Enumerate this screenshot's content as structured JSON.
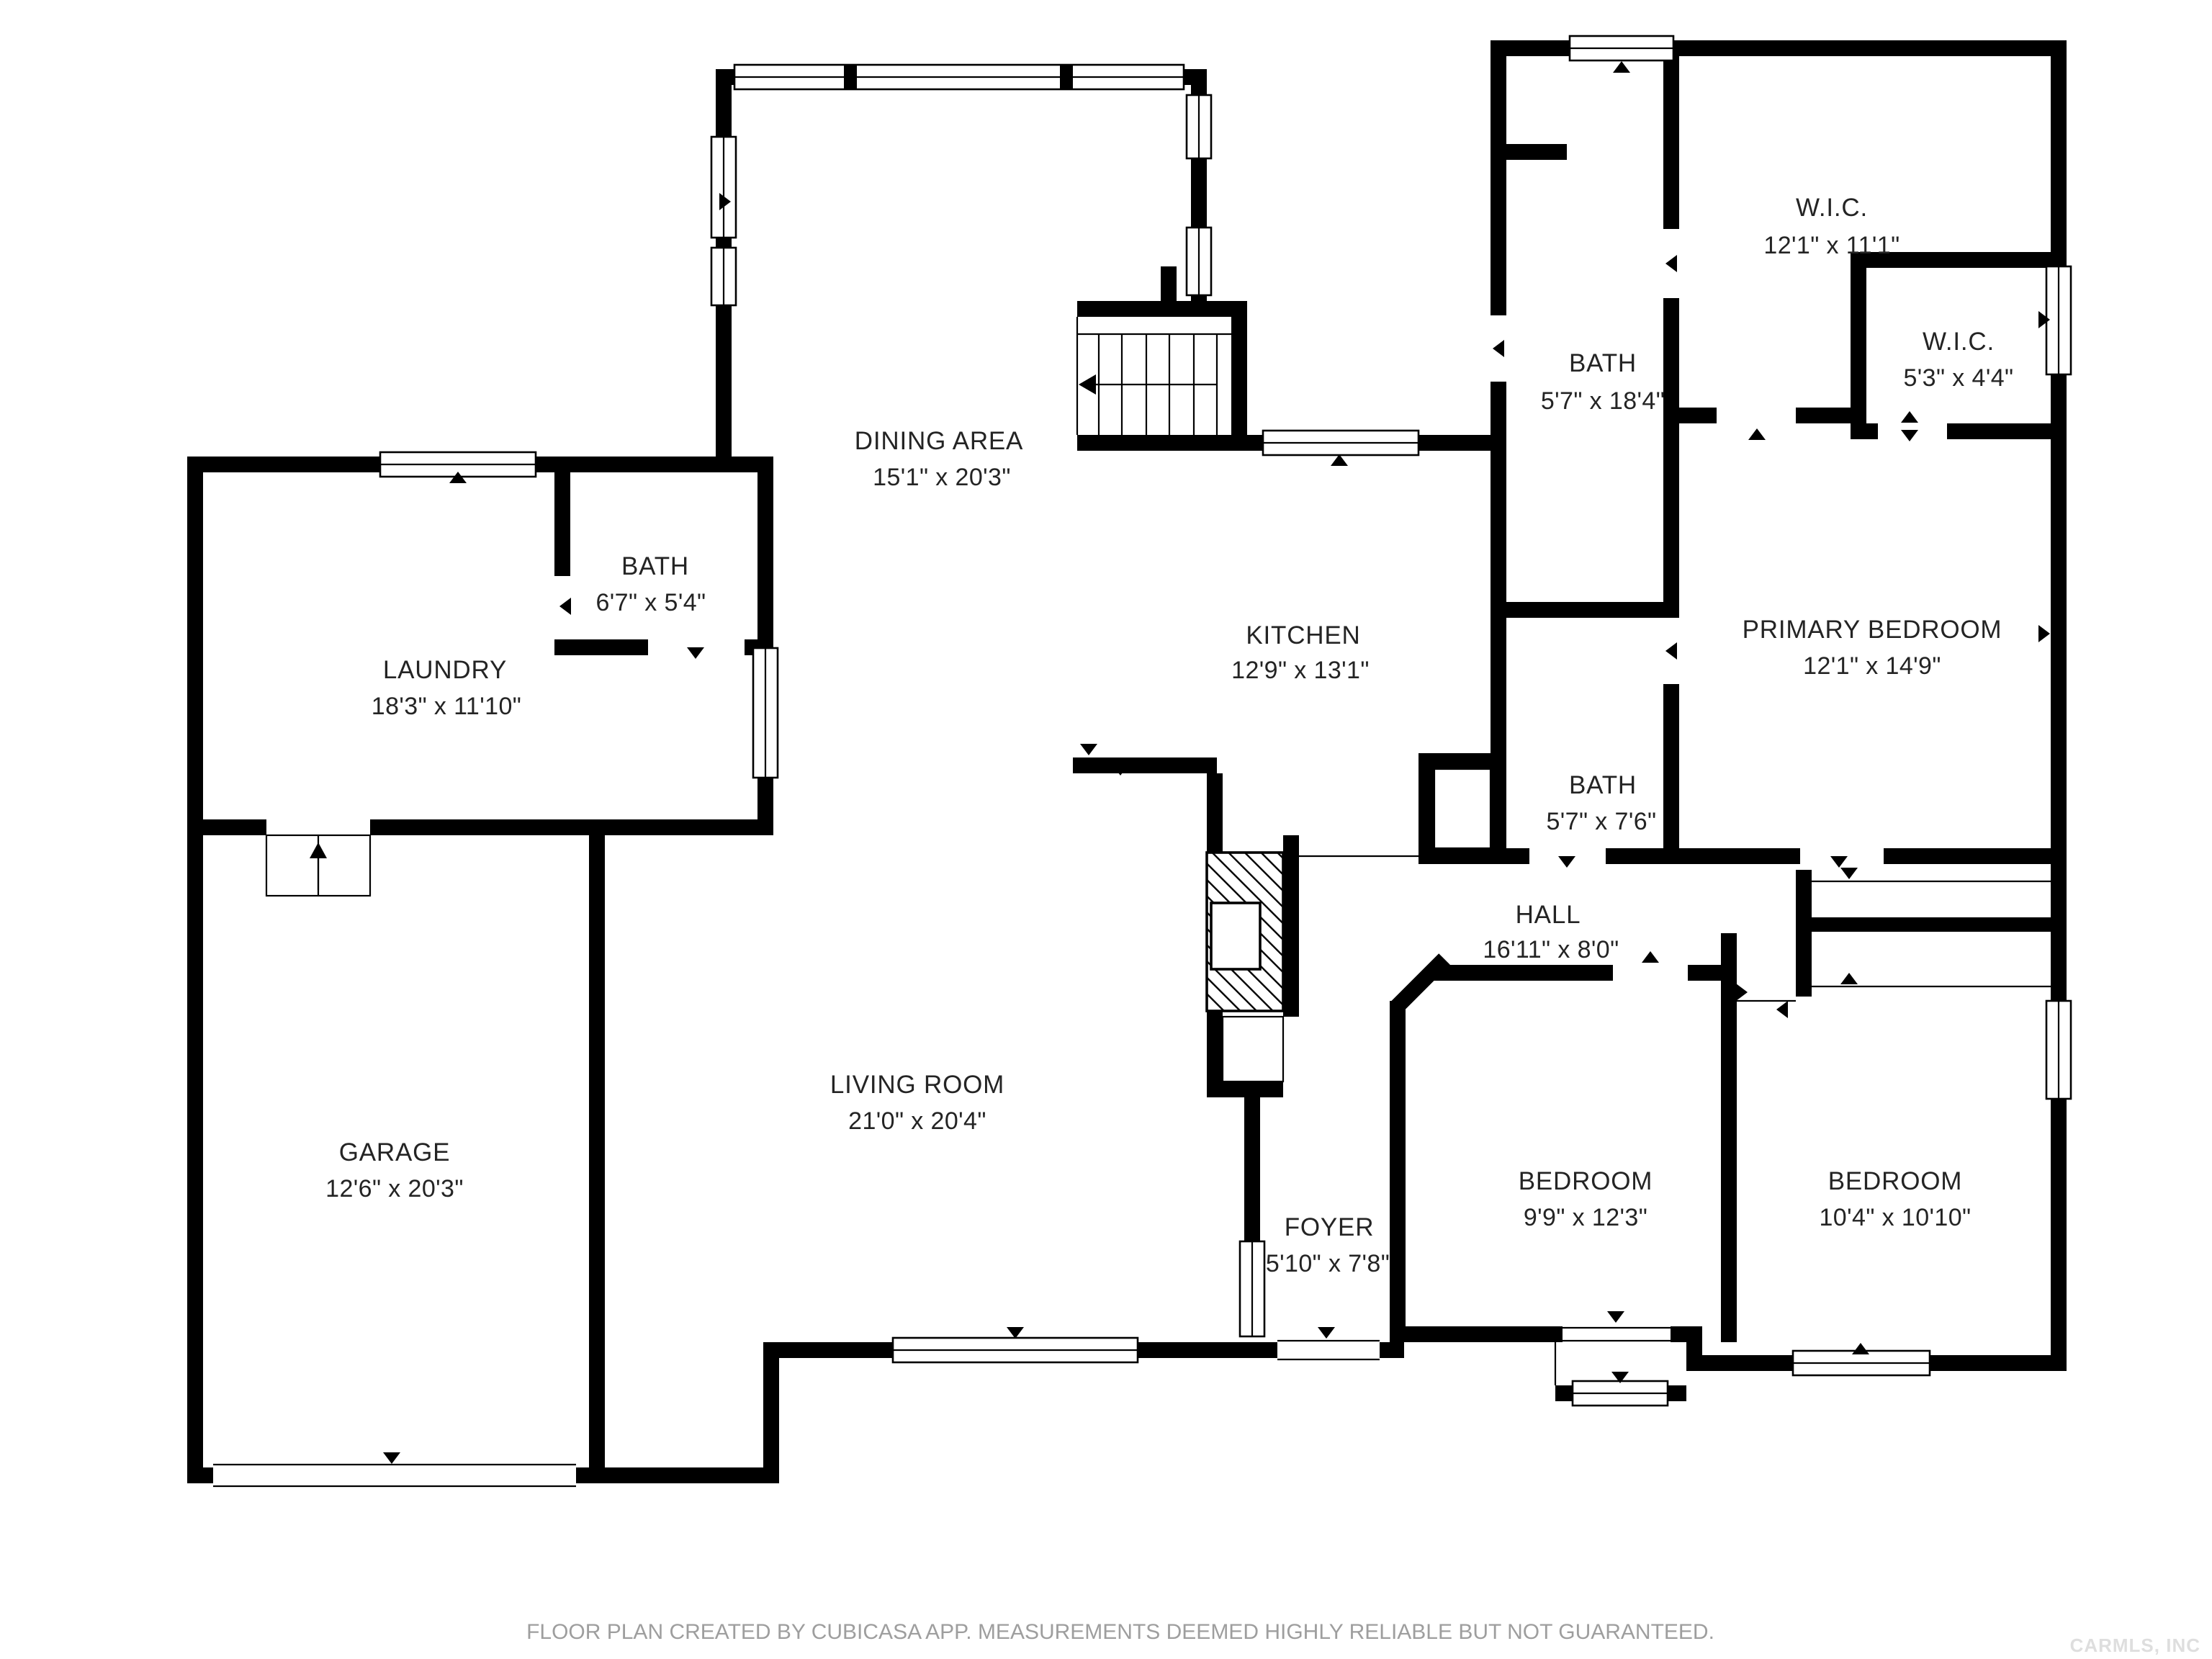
{
  "rooms": [
    {
      "id": "wic-1",
      "name": "W.I.C.",
      "dims": "12'1\" x 11'1\""
    },
    {
      "id": "wic-2",
      "name": "W.I.C.",
      "dims": "5'3\" x 4'4\""
    },
    {
      "id": "bath-upper",
      "name": "BATH",
      "dims": "5'7\" x 18'4\""
    },
    {
      "id": "dining-area",
      "name": "DINING AREA",
      "dims": "15'1\" x 20'3\""
    },
    {
      "id": "bath-laundry",
      "name": "BATH",
      "dims": "6'7\" x 5'4\""
    },
    {
      "id": "laundry",
      "name": "LAUNDRY",
      "dims": "18'3\" x 11'10\""
    },
    {
      "id": "kitchen",
      "name": "KITCHEN",
      "dims": "12'9\" x 13'1\""
    },
    {
      "id": "primary-bedroom",
      "name": "PRIMARY BEDROOM",
      "dims": "12'1\" x 14'9\""
    },
    {
      "id": "bath-hall",
      "name": "BATH",
      "dims": "5'7\" x 7'6\""
    },
    {
      "id": "hall",
      "name": "HALL",
      "dims": "16'11\" x 8'0\""
    },
    {
      "id": "garage",
      "name": "GARAGE",
      "dims": "12'6\" x 20'3\""
    },
    {
      "id": "living-room",
      "name": "LIVING ROOM",
      "dims": "21'0\" x 20'4\""
    },
    {
      "id": "foyer",
      "name": "FOYER",
      "dims": "5'10\" x 7'8\""
    },
    {
      "id": "bedroom-1",
      "name": "BEDROOM",
      "dims": "9'9\" x 12'3\""
    },
    {
      "id": "bedroom-2",
      "name": "BEDROOM",
      "dims": "10'4\" x 10'10\""
    }
  ],
  "footer": {
    "disclaimer": "FLOOR PLAN CREATED BY CUBICASA APP. MEASUREMENTS DEEMED HIGHLY RELIABLE BUT NOT GUARANTEED."
  },
  "watermark": {
    "text": "CARMLS, INC"
  },
  "colors": {
    "wall": "#000000",
    "background": "#ffffff",
    "label_text": "#242424",
    "footer_text": "#9e9e9e",
    "watermark_text": "#dedede"
  }
}
